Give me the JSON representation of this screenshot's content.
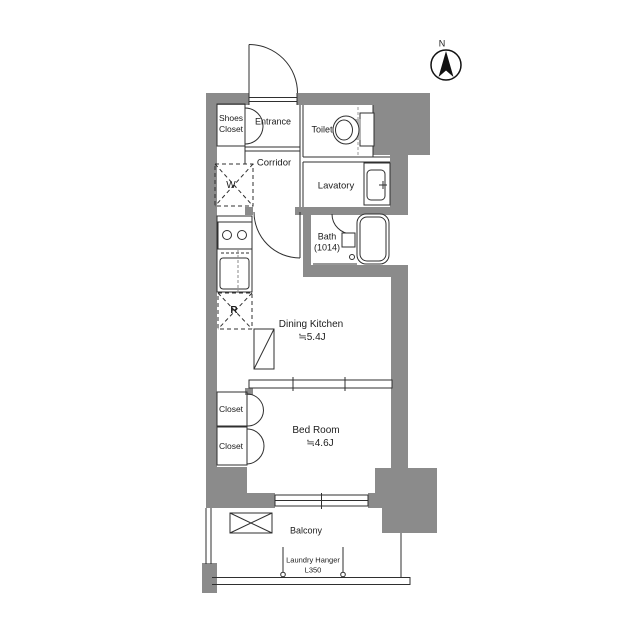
{
  "compass": {
    "label": "N"
  },
  "colors": {
    "wall_gray": "#8b8b8b",
    "line": "#2f2f2f",
    "background": "#ffffff"
  },
  "rooms": {
    "shoes_closet": {
      "line1": "Shoes",
      "line2": "Closet"
    },
    "entrance": {
      "label": "Entrance"
    },
    "toilet": {
      "label": "Toilet"
    },
    "corridor": {
      "label": "Corridor"
    },
    "washer": {
      "label": "W"
    },
    "lavatory": {
      "label": "Lavatory"
    },
    "bath": {
      "label": "Bath",
      "size": "(1014)"
    },
    "dining_kitchen": {
      "label": "Dining Kitchen",
      "size": "≒5.4J"
    },
    "refrigerator": {
      "label": "R"
    },
    "closet_upper": {
      "label": "Closet"
    },
    "closet_lower": {
      "label": "Closet"
    },
    "bed_room": {
      "label": "Bed Room",
      "size": "≒4.6J"
    },
    "balcony": {
      "label": "Balcony"
    },
    "laundry_hanger": {
      "label": "Laundry Hanger",
      "size": "L350"
    }
  }
}
